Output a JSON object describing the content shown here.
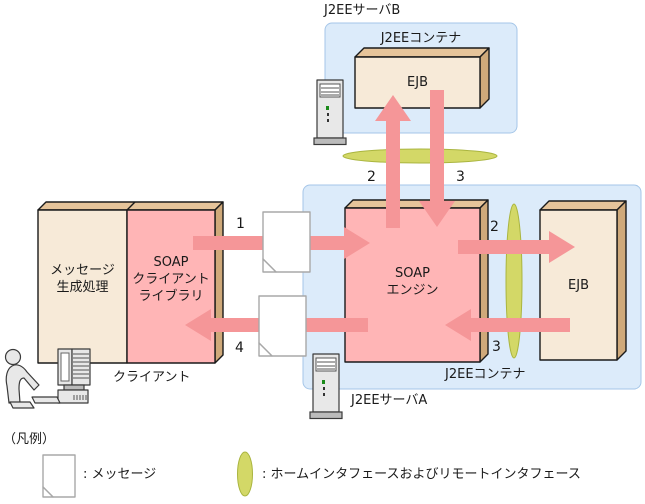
{
  "server_b": {
    "title": "J2EEサーバB",
    "container": "J2EEコンテナ",
    "ejb": "EJB"
  },
  "server_a": {
    "title": "J2EEサーバA",
    "container": "J2EEコンテナ",
    "soap_engine": "SOAP\nエンジン",
    "ejb": "EJB"
  },
  "client": {
    "message_process": "メッセージ\n生成処理",
    "soap_library": "SOAP\nクライアント\nライブラリ",
    "caption": "クライアント"
  },
  "flow": {
    "step1": "1",
    "step2": "2",
    "step3": "3",
    "step4": "4"
  },
  "legend": {
    "title": "（凡例）",
    "message_label": ": メッセージ",
    "interface_label": ": ホームインタフェースおよびリモートインタフェース"
  },
  "colors": {
    "container_fill": "#dcebfa",
    "container_border": "#a5c6e8",
    "box_front_beige": "#f7ead8",
    "box_front_pink": "#ffb5b6",
    "box_top": "#e6c49a",
    "box_side": "#cfa97a",
    "arrow": "#f59698",
    "interface_fill": "#d3d867",
    "interface_stroke": "#aab53f"
  }
}
